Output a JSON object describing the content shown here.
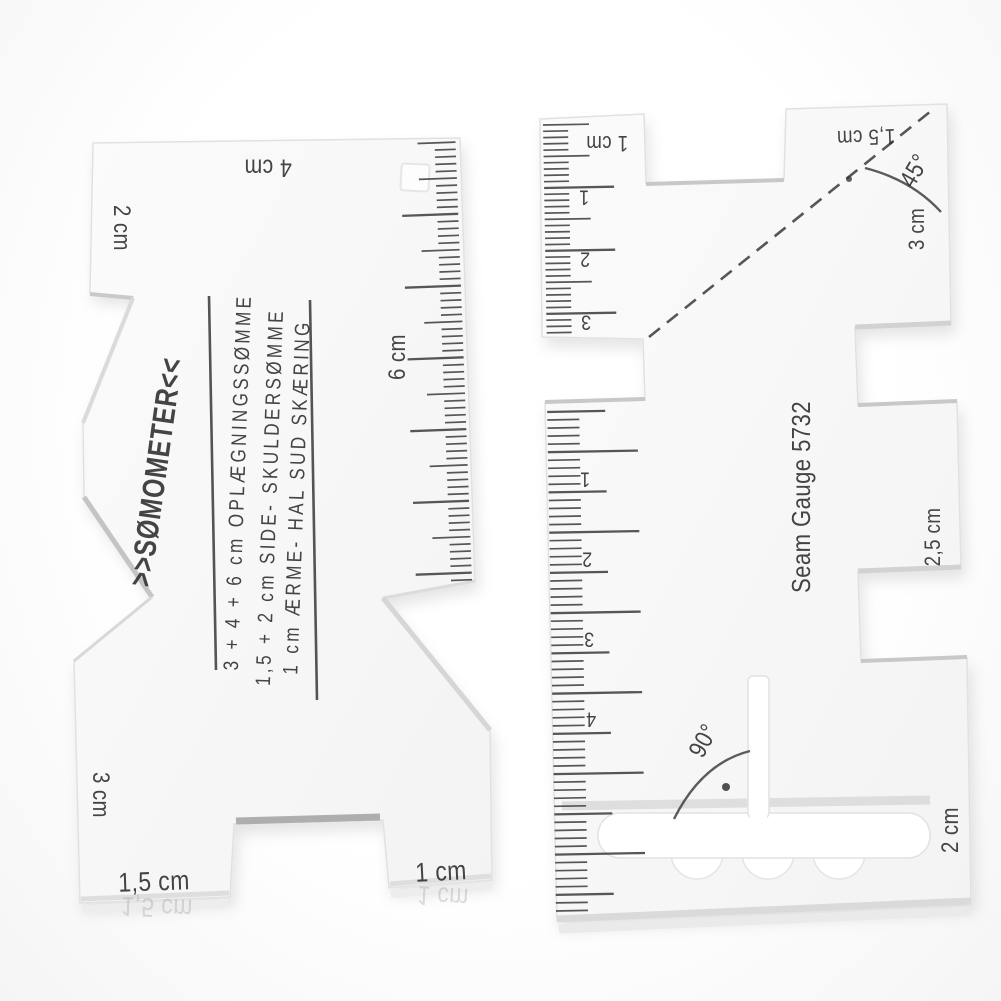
{
  "left_gauge": {
    "brand": ">>SØMOMETER<<",
    "instruction_lines": [
      "3 + 4 + 6 cm OPLÆGNINGSSØMME",
      "1,5 + 2 cm SIDE- SKULDERSØMME",
      "1 cm ÆRME- HAL SUD SKÆRING"
    ],
    "labels": {
      "top_left": "2 cm",
      "top": "4 cm",
      "scale": "6 cm",
      "left_bottom": "3 cm",
      "bottom_left": "1,5 cm",
      "bottom_right": "1 cm",
      "bottom_left_reflection": "1,5 cm",
      "bottom_right_reflection": "1 cm"
    }
  },
  "right_gauge": {
    "model": "Seam Gauge 5732",
    "labels": {
      "top_left": "1 cm",
      "top_right": "1,5 cm",
      "angle_top": "45°",
      "right_top": "3 cm",
      "right_middle": "2,5 cm",
      "angle_bottom": "90°",
      "bottom_right": "2 cm"
    },
    "upper_scale_numbers": [
      "1",
      "2",
      "3"
    ],
    "lower_scale_numbers": [
      "1",
      "2",
      "3",
      "4"
    ]
  },
  "colors": {
    "background": "#fdfdfd",
    "acrylic": "#f8f8f8",
    "ink": "#2c2c2c",
    "edge": "#d6d6d6"
  }
}
